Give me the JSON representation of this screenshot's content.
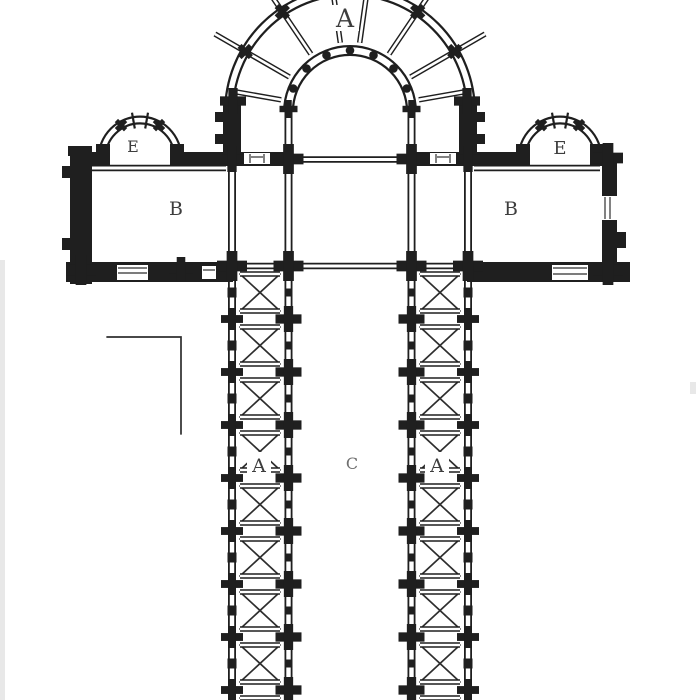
{
  "plan": {
    "labels": {
      "apse": "A",
      "chapel_left": "E",
      "chapel_right": "E",
      "transept_left": "B",
      "transept_right": "B",
      "aisle_left": "A",
      "nave": "C",
      "aisle_right": "A"
    },
    "colors": {
      "ink": "#1f1f1f",
      "line": "#2e2e2e",
      "label_ink": "#3d3d3d",
      "nave_label_ink": "#6f6f6f",
      "paper": "#ffffff"
    }
  }
}
